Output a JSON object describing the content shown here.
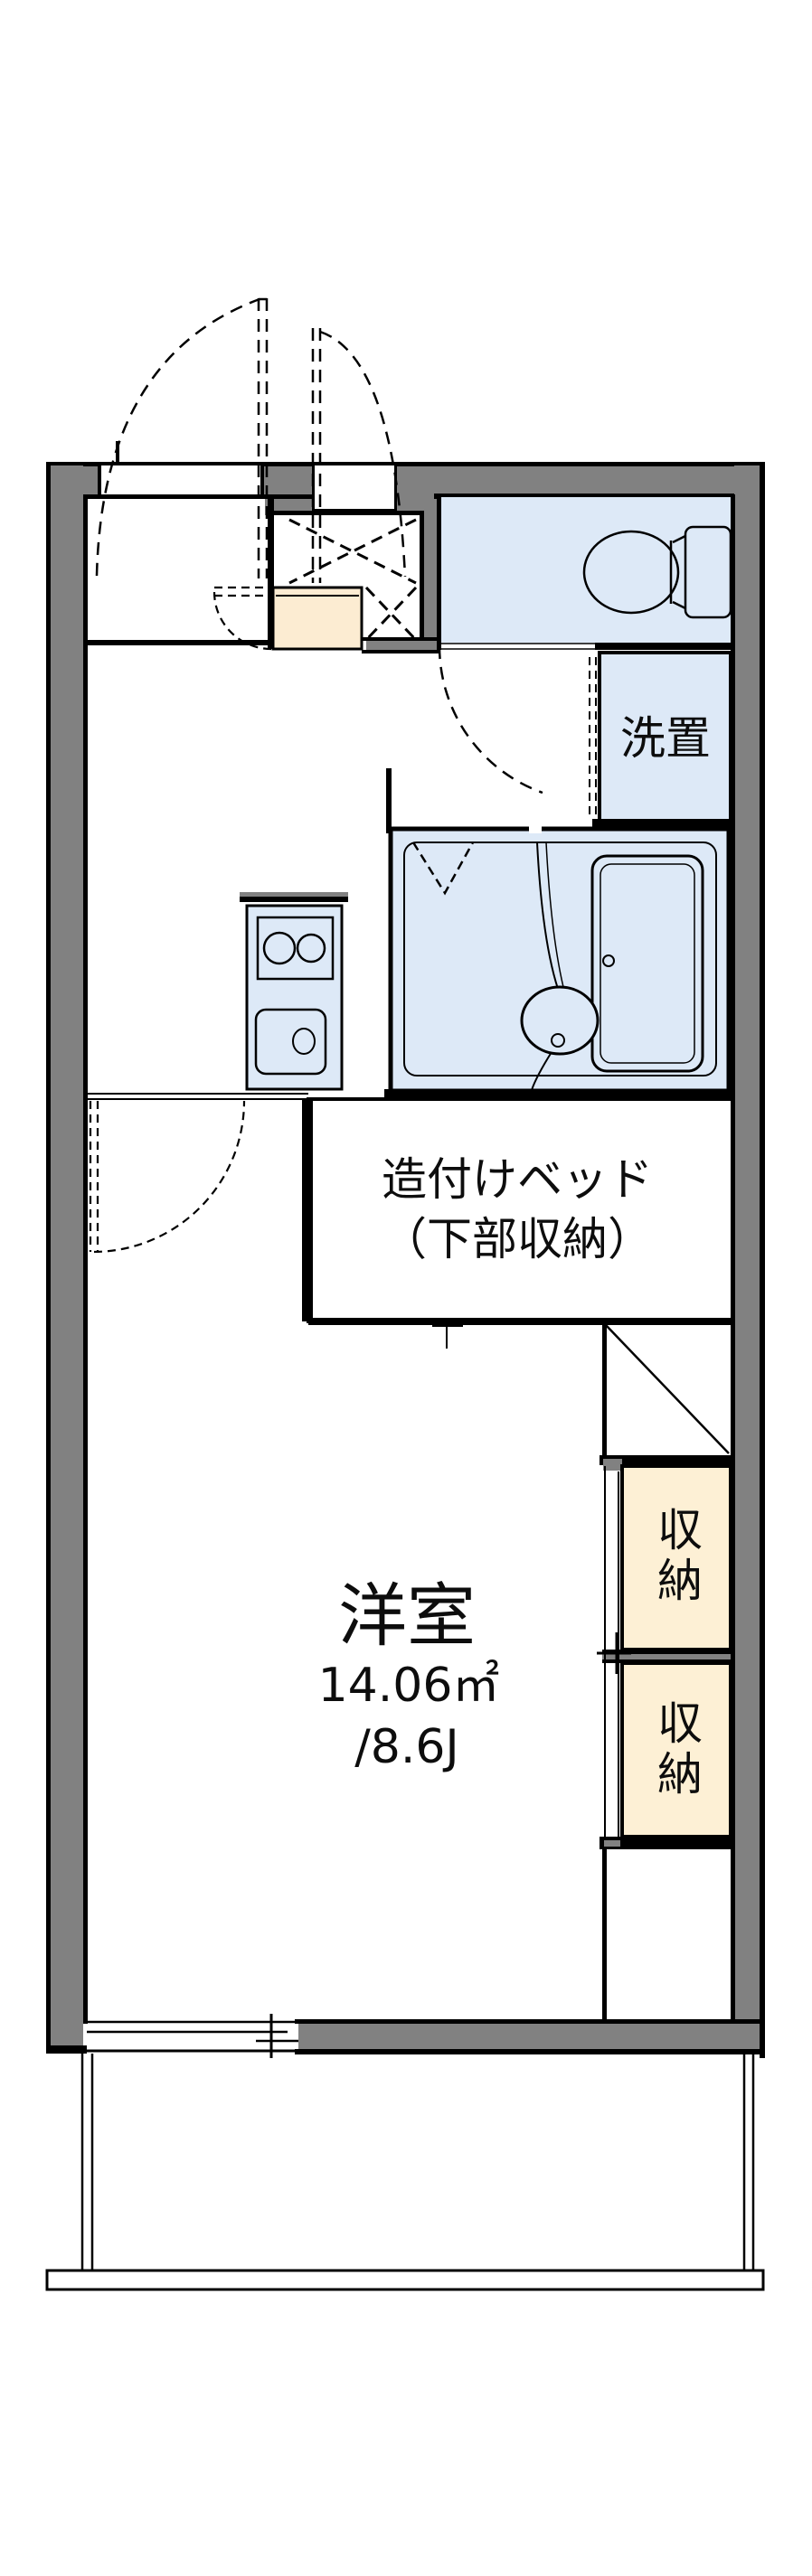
{
  "floorplan": {
    "labels": {
      "laundry": "洗置",
      "bed_line1": "造付けベッド",
      "bed_line2": "（下部収納）",
      "room_name": "洋室",
      "room_area": "14.06㎡",
      "room_tatami": "/8.6J",
      "storage_top": "収納",
      "storage_bottom": "収納"
    },
    "colors": {
      "wall_gray": "#818181",
      "wet_area_blue": "#dde9f7",
      "storage_cream": "#fdf0d5",
      "entry_step_cream": "#fcecd2",
      "line_black": "#000000"
    }
  }
}
